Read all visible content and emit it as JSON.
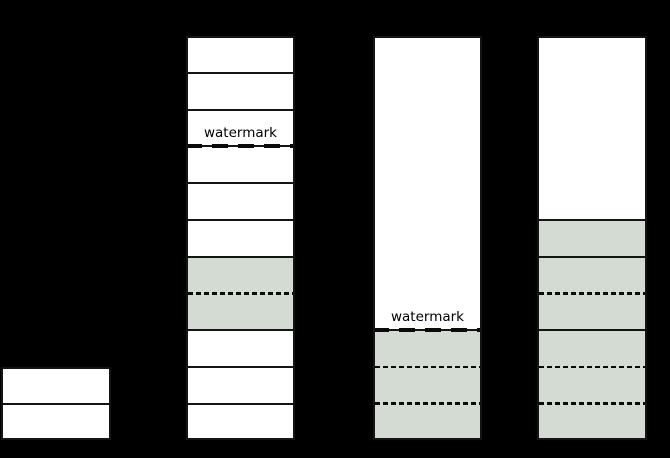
{
  "canvas": {
    "width": 670,
    "height": 458,
    "background": "#000000"
  },
  "palette": {
    "background": "#000000",
    "border": "#141414",
    "dash": "#0a0a0a",
    "text": "#000000",
    "fills": {
      "white": "#ffffff",
      "green": "#d3dbd3"
    }
  },
  "watermark_label": "watermark",
  "diagram": {
    "grid": {
      "top": 36,
      "unit": 36.75,
      "rows": 11
    },
    "columns": [
      {
        "name": "column-1",
        "x": 1,
        "width": 110,
        "start_row": 9,
        "cells": [
          {
            "span": 1,
            "fill": "white"
          },
          {
            "span": 1,
            "fill": "white"
          }
        ]
      },
      {
        "name": "column-2",
        "x": 186,
        "width": 109,
        "start_row": 0,
        "cells": [
          {
            "span": 1,
            "fill": "white"
          },
          {
            "span": 1,
            "fill": "white"
          },
          {
            "span": 1,
            "fill": "white",
            "watermark_below": true
          },
          {
            "span": 1,
            "fill": "white"
          },
          {
            "span": 1,
            "fill": "white"
          },
          {
            "span": 1,
            "fill": "white"
          },
          {
            "span": 2,
            "fill": "green",
            "inner_dividers": 1
          },
          {
            "span": 1,
            "fill": "white"
          },
          {
            "span": 1,
            "fill": "white"
          },
          {
            "span": 1,
            "fill": "white"
          }
        ]
      },
      {
        "name": "column-3",
        "x": 373,
        "width": 109,
        "start_row": 0,
        "cells": [
          {
            "span": 8,
            "fill": "white",
            "watermark_below": true
          },
          {
            "span": 3,
            "fill": "green",
            "inner_dividers": 2
          }
        ]
      },
      {
        "name": "column-4",
        "x": 537,
        "width": 110,
        "start_row": 0,
        "cells": [
          {
            "span": 5,
            "fill": "white"
          },
          {
            "span": 1,
            "fill": "green"
          },
          {
            "span": 2,
            "fill": "green",
            "inner_dividers": 1
          },
          {
            "span": 3,
            "fill": "green",
            "inner_dividers": 2
          }
        ]
      }
    ]
  }
}
